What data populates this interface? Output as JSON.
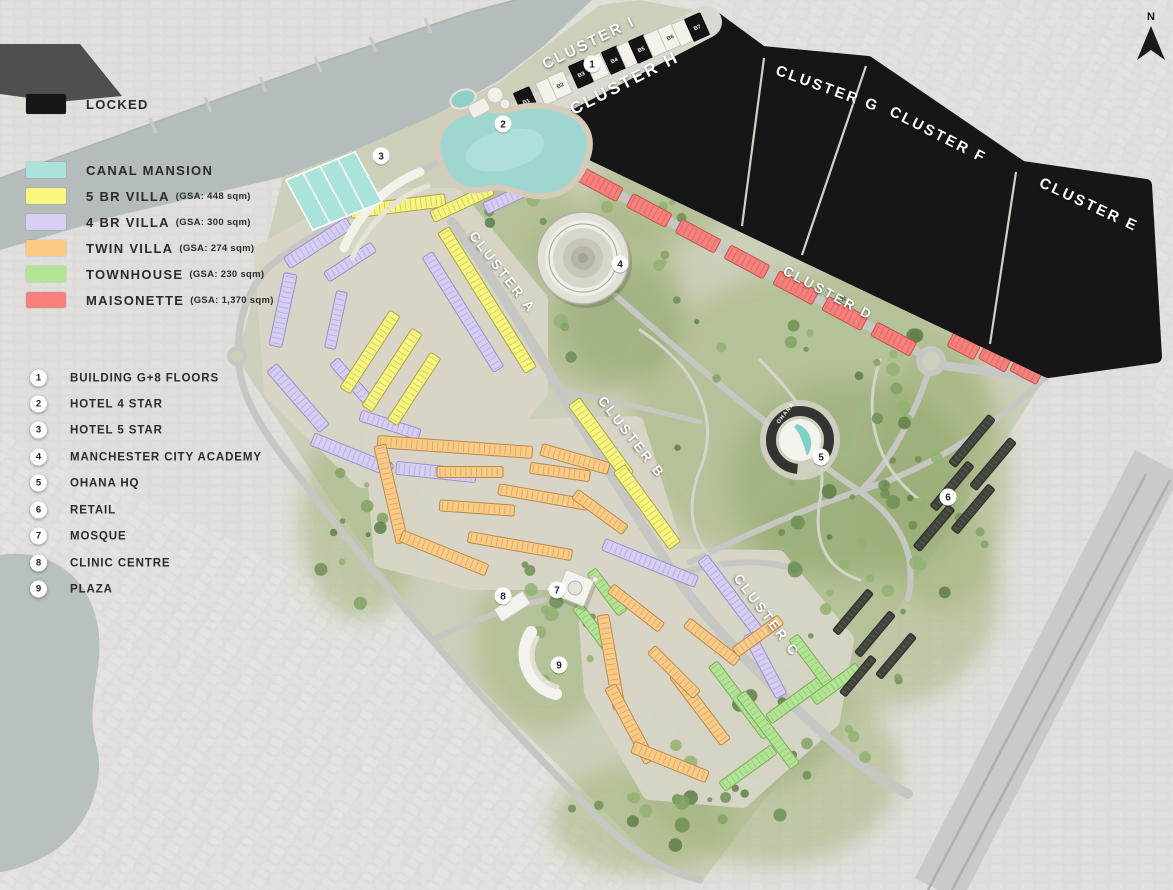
{
  "north_label": "N",
  "map_labels": {
    "hq": "OHANA"
  },
  "legend": {
    "locked": {
      "label": "LOCKED",
      "color": "#171717"
    },
    "items": [
      {
        "label": "CANAL MANSION",
        "gsa": "",
        "color": "#a9e3da"
      },
      {
        "label": "5 BR VILLA",
        "gsa": "(GSA: 448 sqm)",
        "color": "#f8f67e"
      },
      {
        "label": "4 BR VILLA",
        "gsa": "(GSA: 300 sqm)",
        "color": "#d8cdf2"
      },
      {
        "label": "TWIN VILLA",
        "gsa": "(GSA: 274 sqm)",
        "color": "#fbca87"
      },
      {
        "label": "TOWNHOUSE",
        "gsa": "(GSA: 230 sqm)",
        "color": "#b3e395"
      },
      {
        "label": "MAISONETTE",
        "gsa": "(GSA: 1,370 sqm)",
        "color": "#f5817c"
      }
    ]
  },
  "key_items": [
    {
      "num": "1",
      "label": "BUILDING G+8 FLOORS"
    },
    {
      "num": "2",
      "label": "HOTEL 4 STAR"
    },
    {
      "num": "3",
      "label": "HOTEL 5 STAR"
    },
    {
      "num": "4",
      "label": "MANCHESTER CITY ACADEMY"
    },
    {
      "num": "5",
      "label": "OHANA HQ"
    },
    {
      "num": "6",
      "label": "RETAIL"
    },
    {
      "num": "7",
      "label": "MOSQUE"
    },
    {
      "num": "8",
      "label": "CLINIC CENTRE"
    },
    {
      "num": "9",
      "label": "PLAZA"
    }
  ],
  "clusters": [
    {
      "label": "CLUSTER I",
      "x": 591,
      "y": 47,
      "angle": -26,
      "size": 15
    },
    {
      "label": "CLUSTER H",
      "x": 627,
      "y": 88,
      "angle": -27,
      "size": 17
    },
    {
      "label": "CLUSTER G",
      "x": 826,
      "y": 93,
      "angle": 20,
      "size": 15
    },
    {
      "label": "CLUSTER F",
      "x": 936,
      "y": 139,
      "angle": 27,
      "size": 15
    },
    {
      "label": "CLUSTER E",
      "x": 1087,
      "y": 209,
      "angle": 25,
      "size": 15
    },
    {
      "label": "CLUSTER D",
      "x": 826,
      "y": 297,
      "angle": 28,
      "size": 13.5
    },
    {
      "label": "CLUSTER A",
      "x": 499,
      "y": 275,
      "angle": 52,
      "size": 13.5
    },
    {
      "label": "CLUSTER B",
      "x": 628,
      "y": 440,
      "angle": 52,
      "size": 13.5
    },
    {
      "label": "CLUSTER C",
      "x": 763,
      "y": 618,
      "angle": 53,
      "size": 13.5
    }
  ],
  "markers": [
    {
      "num": "1",
      "x": 592,
      "y": 64
    },
    {
      "num": "2",
      "x": 503,
      "y": 124
    },
    {
      "num": "3",
      "x": 381,
      "y": 156
    },
    {
      "num": "4",
      "x": 620,
      "y": 264
    },
    {
      "num": "5",
      "x": 821,
      "y": 457
    },
    {
      "num": "6",
      "x": 948,
      "y": 497
    },
    {
      "num": "7",
      "x": 557,
      "y": 590
    },
    {
      "num": "8",
      "x": 503,
      "y": 596
    },
    {
      "num": "9",
      "x": 559,
      "y": 665
    }
  ],
  "buildings": [
    {
      "label": "B1",
      "x": 526,
      "y": 101,
      "dark": true
    },
    {
      "label": "",
      "x": 548,
      "y": 91,
      "dark": false
    },
    {
      "label": "B2",
      "x": 560,
      "y": 85,
      "dark": false
    },
    {
      "label": "B3",
      "x": 581,
      "y": 74,
      "dark": true
    },
    {
      "label": "",
      "x": 597,
      "y": 67,
      "dark": false
    },
    {
      "label": "B4",
      "x": 614,
      "y": 60,
      "dark": true
    },
    {
      "label": "",
      "x": 629,
      "y": 54,
      "dark": false
    },
    {
      "label": "B5",
      "x": 641,
      "y": 49,
      "dark": true
    },
    {
      "label": "",
      "x": 656,
      "y": 43,
      "dark": false
    },
    {
      "label": "B6",
      "x": 670,
      "y": 37,
      "dark": false
    },
    {
      "label": "",
      "x": 684,
      "y": 32,
      "dark": false
    },
    {
      "label": "B7",
      "x": 697,
      "y": 27,
      "dark": true
    }
  ],
  "palette": {
    "canal": "#a9e3da",
    "canal_stroke": "#5fb3a8",
    "villa5": "#f8f67e",
    "villa5_stroke": "#aaa24c",
    "villa4": "#d8cdf2",
    "villa4_stroke": "#9c8cc9",
    "twin": "#fbca87",
    "twin_stroke": "#b68a4a",
    "town": "#b3e395",
    "town_stroke": "#7cab57",
    "maison": "#f5817c",
    "maison_stroke": "#c4514d",
    "locked": "#161616",
    "park": "#a2b47c",
    "tree": "#7d9b5e",
    "road": "#c6c7c2",
    "water": "#b4bcbc",
    "ground": "#ccd0ba",
    "bg": "#dedcd8"
  }
}
